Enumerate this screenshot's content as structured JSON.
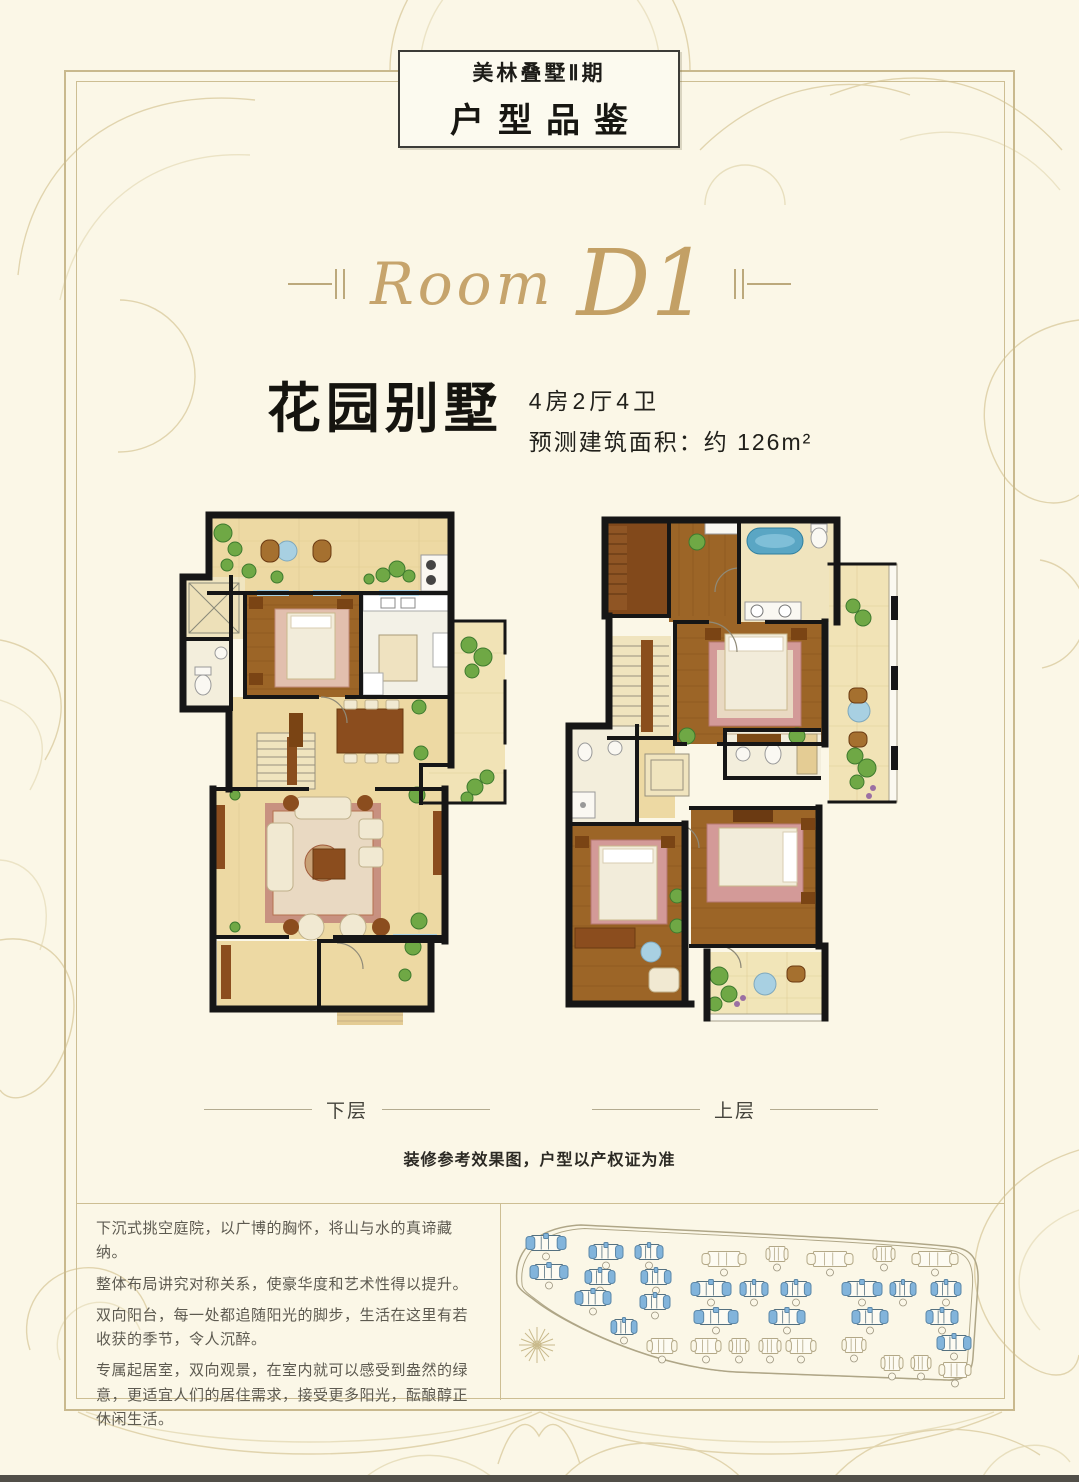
{
  "badge": {
    "line1": "美林叠墅Ⅱ期",
    "line2": "户型品鉴"
  },
  "room_title": {
    "script": "Room",
    "unit": "D1"
  },
  "headline": {
    "title": "花园别墅",
    "spec": "4房2厅4卫",
    "area": "预测建筑面积：约 126m²"
  },
  "floor_labels": {
    "lower": "下层",
    "upper": "上层"
  },
  "note": "装修参考效果图，户型以产权证为准",
  "description": {
    "paragraphs": [
      "下沉式挑空庭院，以广博的胸怀，将山与水的真谛藏纳。",
      "整体布局讲究对称关系，使豪华度和艺术性得以提升。",
      "双向阳台，每一处都追随阳光的脚步，生活在这里有若收获的季节，令人沉醉。",
      "专属起居室，双向观景，在室内就可以感受到盎然的绿意，更适宜人们的居住需求，接受更多阳光，酝酿醇正休闲生活。"
    ]
  },
  "colors": {
    "page_bg": "#FBF7E7",
    "frame_gold": "#C9B98E",
    "accent_gold": "#C6A46C",
    "wall_black": "#161616",
    "floor_tan": "#EDD9A3",
    "wood_brown": "#9C6527",
    "window_blue": "#A8D0E2",
    "building_blue": "#82B4DB",
    "plant_green": "#5E9A3C"
  },
  "site_plan": {
    "buildings": [
      {
        "x": 45,
        "y": 38,
        "w": 40,
        "b": 1
      },
      {
        "x": 105,
        "y": 47,
        "w": 34,
        "b": 1
      },
      {
        "x": 148,
        "y": 47,
        "w": 28,
        "b": 1
      },
      {
        "x": 48,
        "y": 67,
        "w": 38,
        "b": 1
      },
      {
        "x": 99,
        "y": 72,
        "w": 30,
        "b": 1
      },
      {
        "x": 155,
        "y": 72,
        "w": 30,
        "b": 1
      },
      {
        "x": 92,
        "y": 93,
        "w": 36,
        "b": 1
      },
      {
        "x": 154,
        "y": 97,
        "w": 30,
        "b": 1
      },
      {
        "x": 123,
        "y": 122,
        "w": 26,
        "b": 1
      },
      {
        "x": 210,
        "y": 84,
        "w": 40,
        "b": 1
      },
      {
        "x": 253,
        "y": 84,
        "w": 28,
        "b": 1
      },
      {
        "x": 295,
        "y": 84,
        "w": 30,
        "b": 1
      },
      {
        "x": 361,
        "y": 84,
        "w": 40,
        "b": 1
      },
      {
        "x": 402,
        "y": 84,
        "w": 26,
        "b": 1
      },
      {
        "x": 445,
        "y": 84,
        "w": 30,
        "b": 1
      },
      {
        "x": 215,
        "y": 112,
        "w": 44,
        "b": 1
      },
      {
        "x": 286,
        "y": 112,
        "w": 36,
        "b": 1
      },
      {
        "x": 369,
        "y": 112,
        "w": 36,
        "b": 1
      },
      {
        "x": 441,
        "y": 112,
        "w": 32,
        "b": 1
      },
      {
        "x": 453,
        "y": 138,
        "w": 34,
        "b": 1
      },
      {
        "x": 223,
        "y": 54,
        "w": 44,
        "b": 0
      },
      {
        "x": 276,
        "y": 49,
        "w": 22,
        "b": 0
      },
      {
        "x": 329,
        "y": 54,
        "w": 46,
        "b": 0
      },
      {
        "x": 383,
        "y": 49,
        "w": 22,
        "b": 0
      },
      {
        "x": 434,
        "y": 54,
        "w": 46,
        "b": 0
      },
      {
        "x": 161,
        "y": 141,
        "w": 30,
        "b": 0
      },
      {
        "x": 205,
        "y": 141,
        "w": 30,
        "b": 0
      },
      {
        "x": 238,
        "y": 141,
        "w": 20,
        "b": 0
      },
      {
        "x": 269,
        "y": 141,
        "w": 22,
        "b": 0
      },
      {
        "x": 300,
        "y": 141,
        "w": 30,
        "b": 0
      },
      {
        "x": 353,
        "y": 140,
        "w": 24,
        "b": 0
      },
      {
        "x": 391,
        "y": 158,
        "w": 22,
        "b": 0
      },
      {
        "x": 420,
        "y": 158,
        "w": 20,
        "b": 0
      },
      {
        "x": 454,
        "y": 165,
        "w": 32,
        "b": 0
      }
    ]
  }
}
